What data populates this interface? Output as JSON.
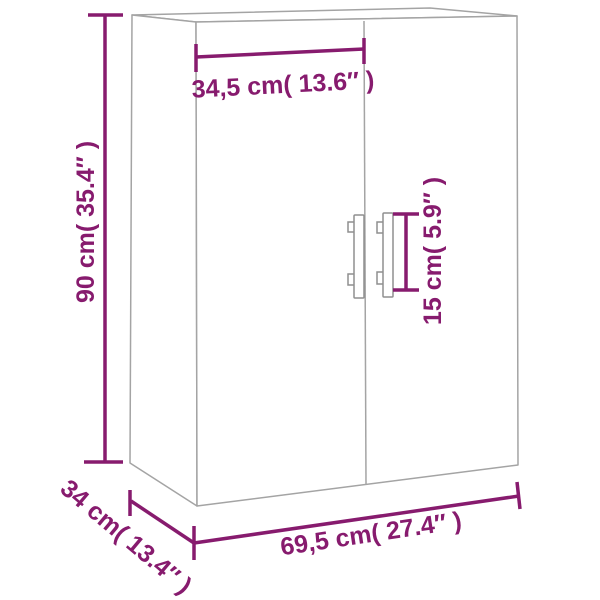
{
  "palette": {
    "background": "#ffffff",
    "dimension_color": "#871b6e",
    "outline_color": "#a4a4a4",
    "outline_color_dark": "#8f8f8f"
  },
  "diagram": {
    "subject": "two-door wall cabinet dimension drawing",
    "dimensions": {
      "door_width": {
        "label": "34,5 cm( 13.6″ )",
        "cm": "34,5",
        "inches": "13.6"
      },
      "height": {
        "label": "90 cm( 35.4″ )",
        "cm": "90",
        "inches": "35.4"
      },
      "handle_length": {
        "label": "15 cm( 5.9″ )",
        "cm": "15",
        "inches": "5.9"
      },
      "depth": {
        "label": "34 cm( 13.4″ )",
        "cm": "34",
        "inches": "13.4"
      },
      "total_width": {
        "label": "69,5 cm( 27.4″ )",
        "cm": "69,5",
        "inches": "27.4"
      }
    }
  }
}
